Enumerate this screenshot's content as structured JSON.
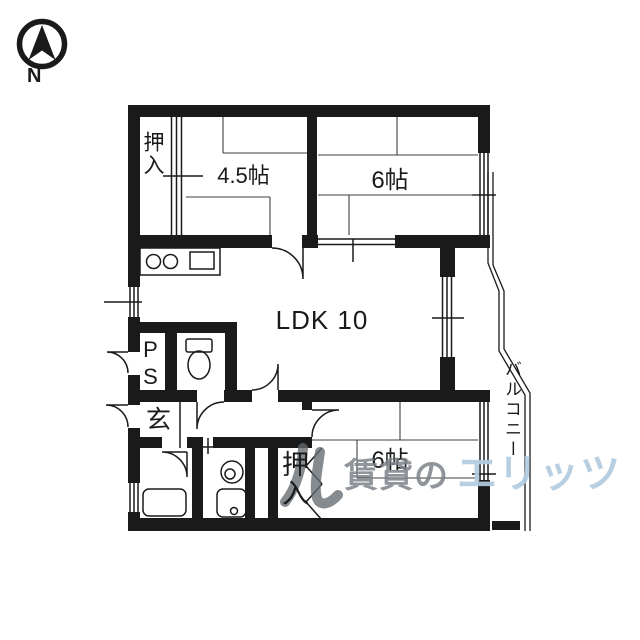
{
  "compass": {
    "north_label": "N"
  },
  "floor_plan": {
    "rooms": {
      "closet_top": {
        "label": "押入"
      },
      "japanese_room_45": {
        "label": "4.5帖"
      },
      "japanese_room_6_top": {
        "label": "6帖"
      },
      "ldk": {
        "label": "LDK 10"
      },
      "pipe_space": {
        "label": "PS"
      },
      "entrance": {
        "label": "玄"
      },
      "closet_bottom": {
        "label": "押入"
      },
      "japanese_room_6_bottom": {
        "label": "6帖"
      },
      "balcony": {
        "label": "バルコニー"
      }
    }
  },
  "watermark": {
    "gray_text": "賃貸の",
    "blue_text": "エリッツ",
    "gray_color": "#7d838a",
    "blue_color": "#b2cbdf"
  },
  "colors": {
    "line": "#1a1a1a",
    "background": "#ffffff"
  }
}
